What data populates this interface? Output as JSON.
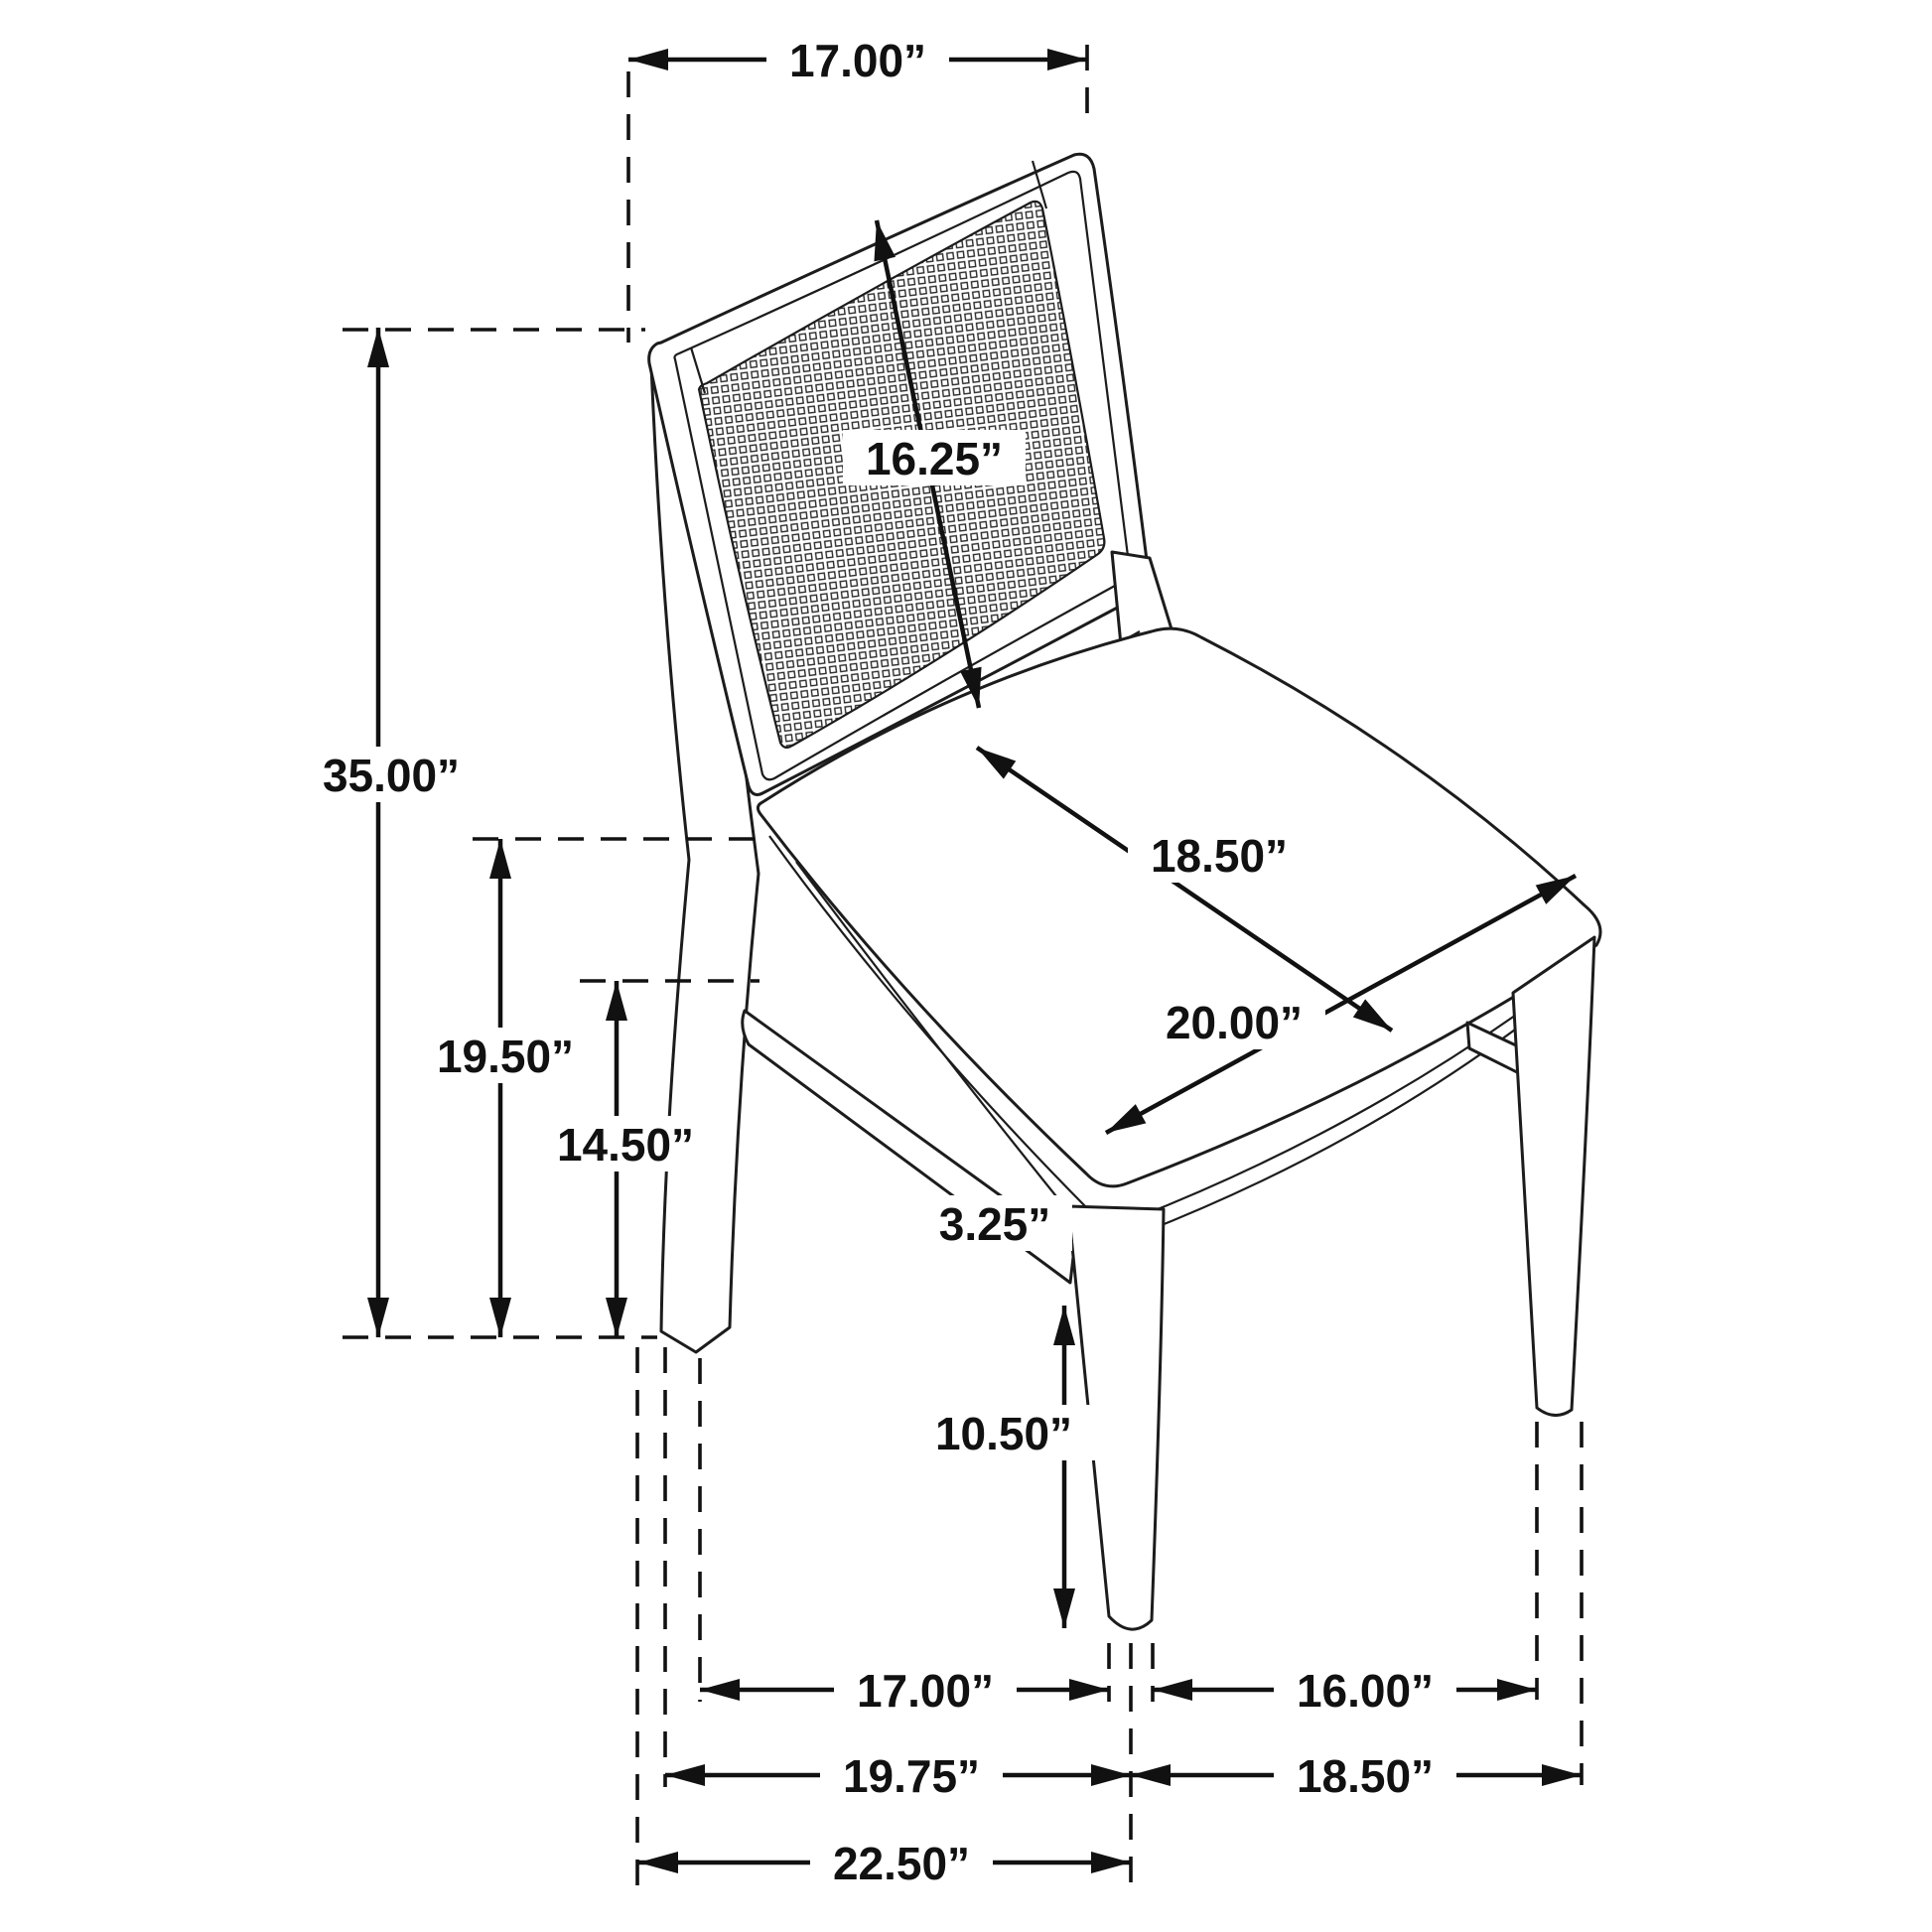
{
  "title": "Dining chair dimension diagram",
  "colors": {
    "line": "#111111",
    "chair_line": "#1c1c1c",
    "background": "#ffffff"
  },
  "units": "inches",
  "dimensions": {
    "back_width": "17.00”",
    "overall_height": "35.00”",
    "back_panel_height": "16.25”",
    "seat_depth": "18.50”",
    "seat_width": "20.00”",
    "seat_height": "19.50”",
    "under_apron_height": "14.50”",
    "apron_to_stretcher_gap": "3.25”",
    "stretcher_to_floor": "10.50”",
    "front_leg_span_left": "17.00”",
    "front_leg_span_right": "16.00”",
    "footprint_left": "19.75”",
    "footprint_right": "18.50”",
    "footprint_overall": "22.50”"
  }
}
